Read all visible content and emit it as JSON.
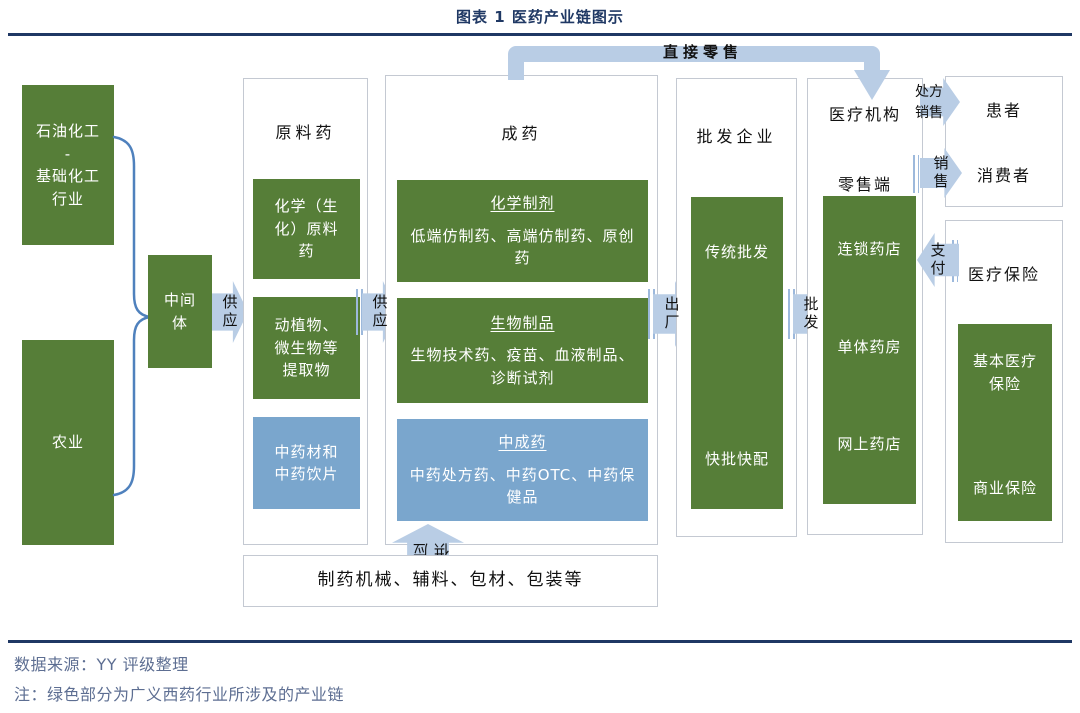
{
  "title": "图表 1 医药产业链图示",
  "colors": {
    "green_box": "#567e38",
    "blue_box": "#7aa6cd",
    "arrow_blue": "#b9cde5",
    "brace_blue": "#4f81bd",
    "navy_rule": "#1f3864",
    "footer_text": "#5d6e92"
  },
  "upstream": {
    "petrochem": "石油化工\n-\n基础化工\n行业",
    "agriculture": "农业",
    "intermediate": "中间体"
  },
  "arrows": {
    "supply1": "供应",
    "supply2": "供应",
    "supply_up": "供应",
    "factory_out": "出厂",
    "wholesale": "批发",
    "direct_retail": "直接零售",
    "prescription_sale": "处方销售",
    "sale": "销售",
    "pay": "支付"
  },
  "api_column": {
    "label": "原料药",
    "boxes": [
      {
        "text": "化学（生化）原料药",
        "type": "green"
      },
      {
        "text": "动植物、微生物等提取物",
        "type": "green"
      },
      {
        "text": "中药材和中药饮片",
        "type": "blue"
      }
    ]
  },
  "drug_column": {
    "label": "成药",
    "boxes": [
      {
        "title": "化学制剂",
        "text": "低端仿制药、高端仿制药、原创药",
        "type": "green"
      },
      {
        "title": "生物制品",
        "text": "生物技术药、疫苗、血液制品、诊断试剂",
        "type": "green"
      },
      {
        "title": "中成药",
        "text": "中药处方药、中药OTC、中药保健品",
        "type": "blue"
      }
    ]
  },
  "auxiliary_box": "制药机械、辅料、包材、包装等",
  "wholesale_column": {
    "label": "批发企业",
    "top": "传统批发",
    "bottom": "快批快配"
  },
  "terminal_column": {
    "label_top": "医疗机构",
    "label_bottom": "零售端",
    "items": [
      "连锁药店",
      "单体药房",
      "网上药店"
    ]
  },
  "consumer_box": {
    "top": "患者",
    "bottom": "消费者"
  },
  "insurance_box": {
    "label": "医疗保险",
    "top": "基本医疗保险",
    "bottom": "商业保险"
  },
  "footer": {
    "source": "数据来源：YY 评级整理",
    "note": "注：绿色部分为广义西药行业所涉及的产业链"
  }
}
